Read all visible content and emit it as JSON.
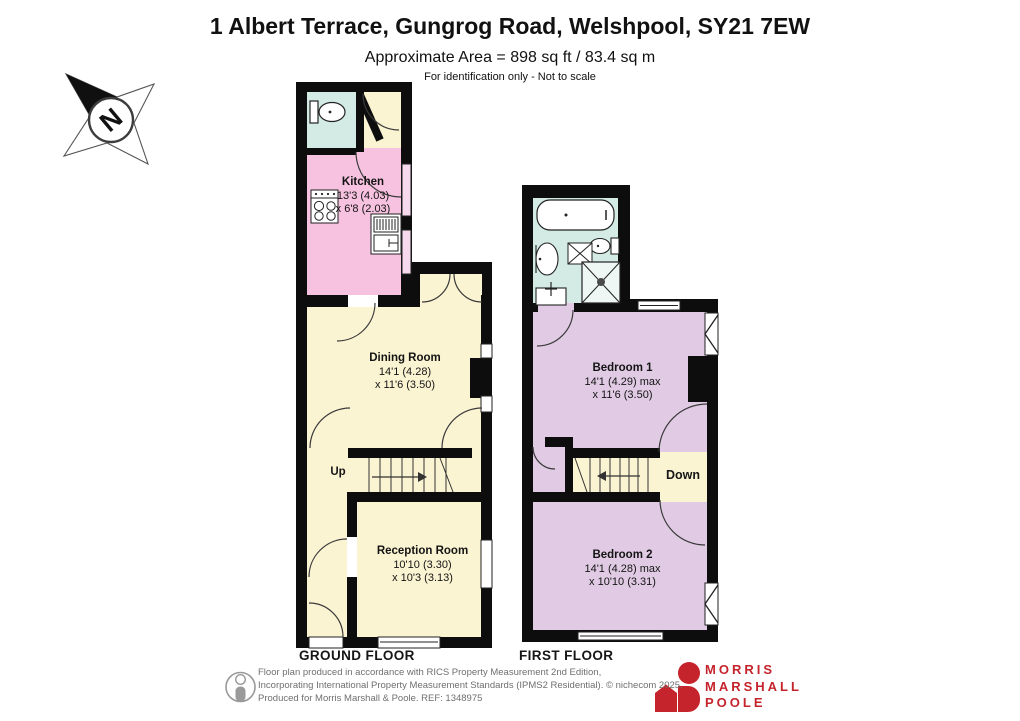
{
  "header": {
    "title": "1 Albert Terrace, Gungrog Road, Welshpool, SY21 7EW",
    "area": "Approximate Area = 898 sq ft / 83.4 sq m",
    "note": "For identification only - Not to scale"
  },
  "compass": {
    "label": "N"
  },
  "ground_floor": {
    "label": "GROUND FLOOR",
    "stairs": "Up",
    "kitchen": {
      "name": "Kitchen",
      "dim1": "13'3 (4.03)",
      "dim2": "x 6'8 (2.03)"
    },
    "dining": {
      "name": "Dining Room",
      "dim1": "14'1 (4.28)",
      "dim2": "x 11'6 (3.50)"
    },
    "reception": {
      "name": "Reception Room",
      "dim1": "10'10 (3.30)",
      "dim2": "x 10'3 (3.13)"
    }
  },
  "first_floor": {
    "label": "FIRST FLOOR",
    "stairs": "Down",
    "bedroom1": {
      "name": "Bedroom 1",
      "dim1": "14'1 (4.29) max",
      "dim2": "x 11'6 (3.50)"
    },
    "bedroom2": {
      "name": "Bedroom 2",
      "dim1": "14'1 (4.28) max",
      "dim2": "x 10'10 (3.31)"
    }
  },
  "footer": {
    "line1": "Floor plan produced in accordance with RICS Property Measurement 2nd Edition,",
    "line2": "Incorporating International Property Measurement Standards (IPMS2 Residential).  © nichecom 2025.",
    "line3": "Produced for Morris Marshall & Poole.   REF: 1348975"
  },
  "logo": {
    "name1": "MORRIS",
    "name2": "MARSHALL",
    "name3": "POOLE"
  },
  "colors": {
    "wall": "#0d0d0d",
    "kitchen": "#f6c2df",
    "living_cream": "#fbf4d3",
    "bathroom_teal": "#d3ebe4",
    "bedroom_lavender": "#e1cbe4",
    "kitchen_window": "#f6d9ec",
    "logo_red": "#c5242c",
    "footer_grey": "#6f6f6f"
  }
}
